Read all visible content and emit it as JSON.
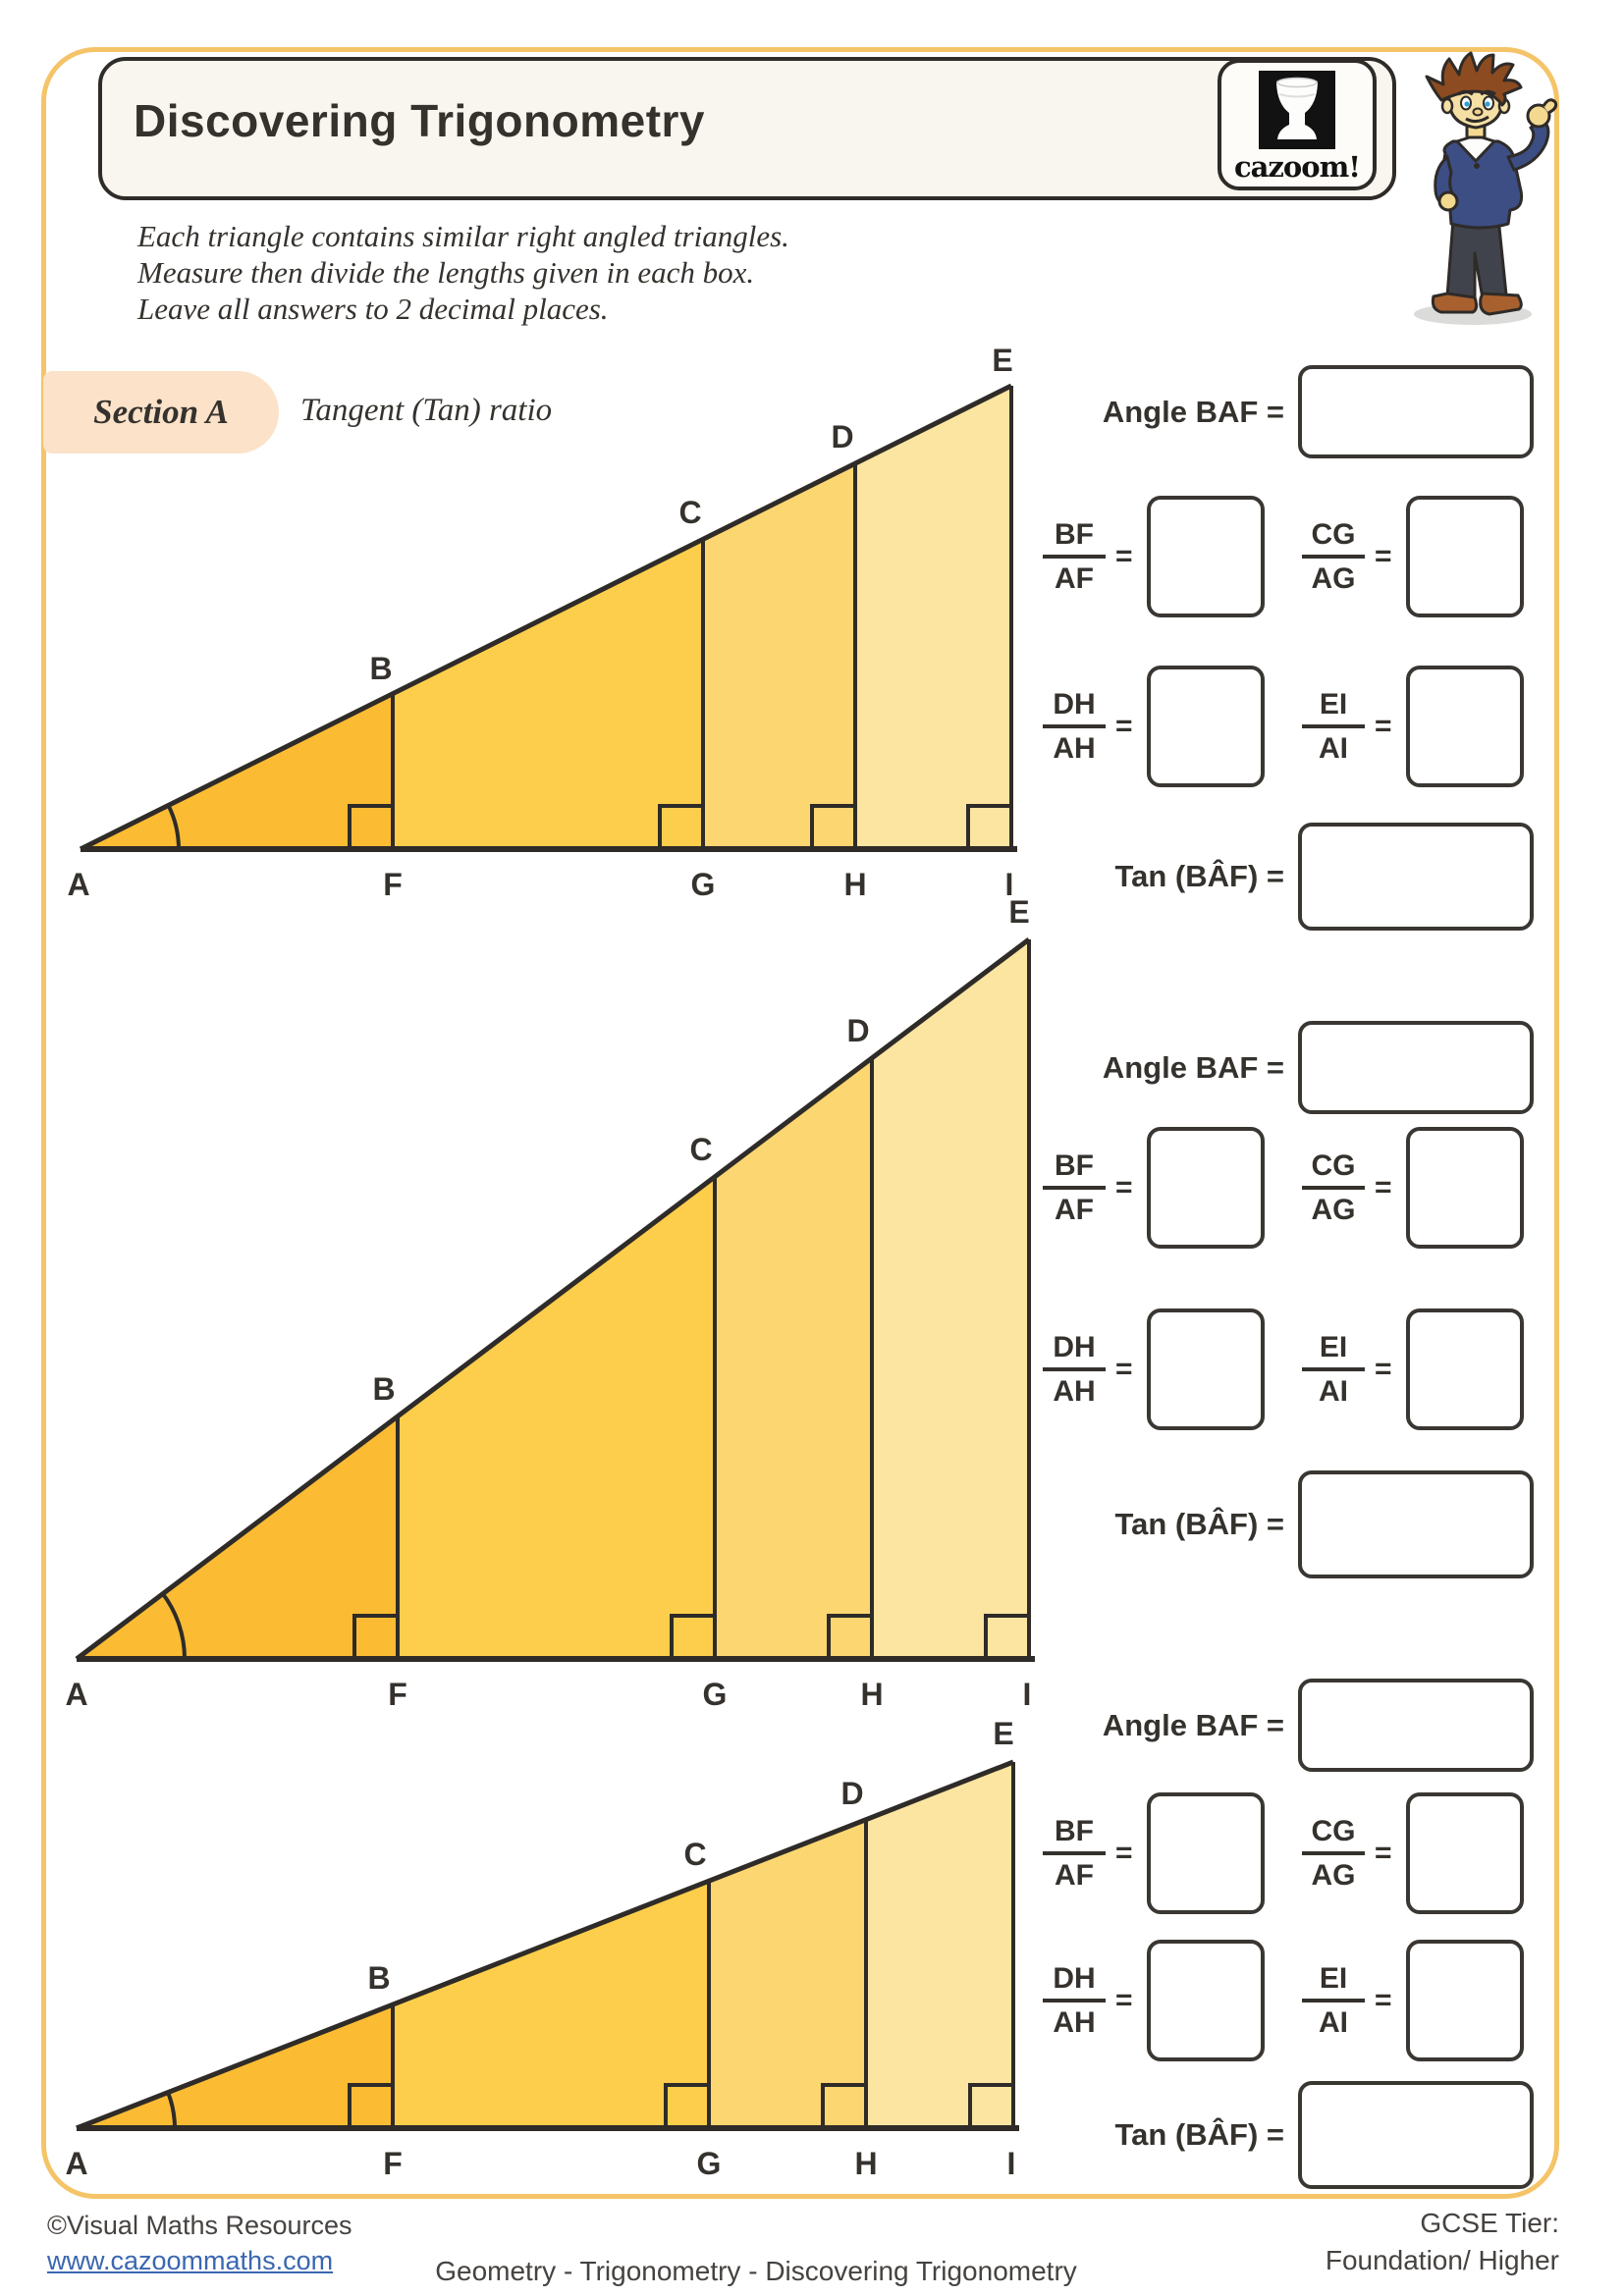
{
  "page": {
    "title": "Discovering Trigonometry",
    "logo_text": "cazoom!",
    "instructions": [
      "Each triangle contains similar right angled triangles.",
      "Measure then divide the lengths given in each box.",
      "Leave all answers to 2 decimal places."
    ],
    "section_label": "Section A",
    "section_topic": "Tangent (Tan) ratio"
  },
  "colors": {
    "page_border": "#F5C469",
    "header_fill": "#F8F6EE",
    "section_chip_fill": "#FBE2C9",
    "outline": "#2E2B28",
    "band_af": "#FBBC33",
    "band_fg": "#FDCE4B",
    "band_gh": "#FCD671",
    "band_hi": "#FCE5A0",
    "link_blue": "#3A67B0"
  },
  "vertices": {
    "a": "A",
    "b": "B",
    "c": "C",
    "d": "D",
    "e": "E",
    "f": "F",
    "g": "G",
    "h": "H",
    "i": "I"
  },
  "answers": {
    "angle_label": "Angle BAF =",
    "tan_label": "Tan (BÂF) =",
    "equals": "=",
    "fractions": [
      {
        "num": "BF",
        "den": "AF"
      },
      {
        "num": "CG",
        "den": "AG"
      },
      {
        "num": "DH",
        "den": "AH"
      },
      {
        "num": "EI",
        "den": "AI"
      }
    ]
  },
  "footer": {
    "copyright": "©Visual Maths Resources",
    "url": "www.cazoommaths.com",
    "center": "Geometry - Trigonometry - Discovering Trigonometry",
    "tier_line1": "GCSE Tier:",
    "tier_line2": "Foundation/ Higher"
  }
}
